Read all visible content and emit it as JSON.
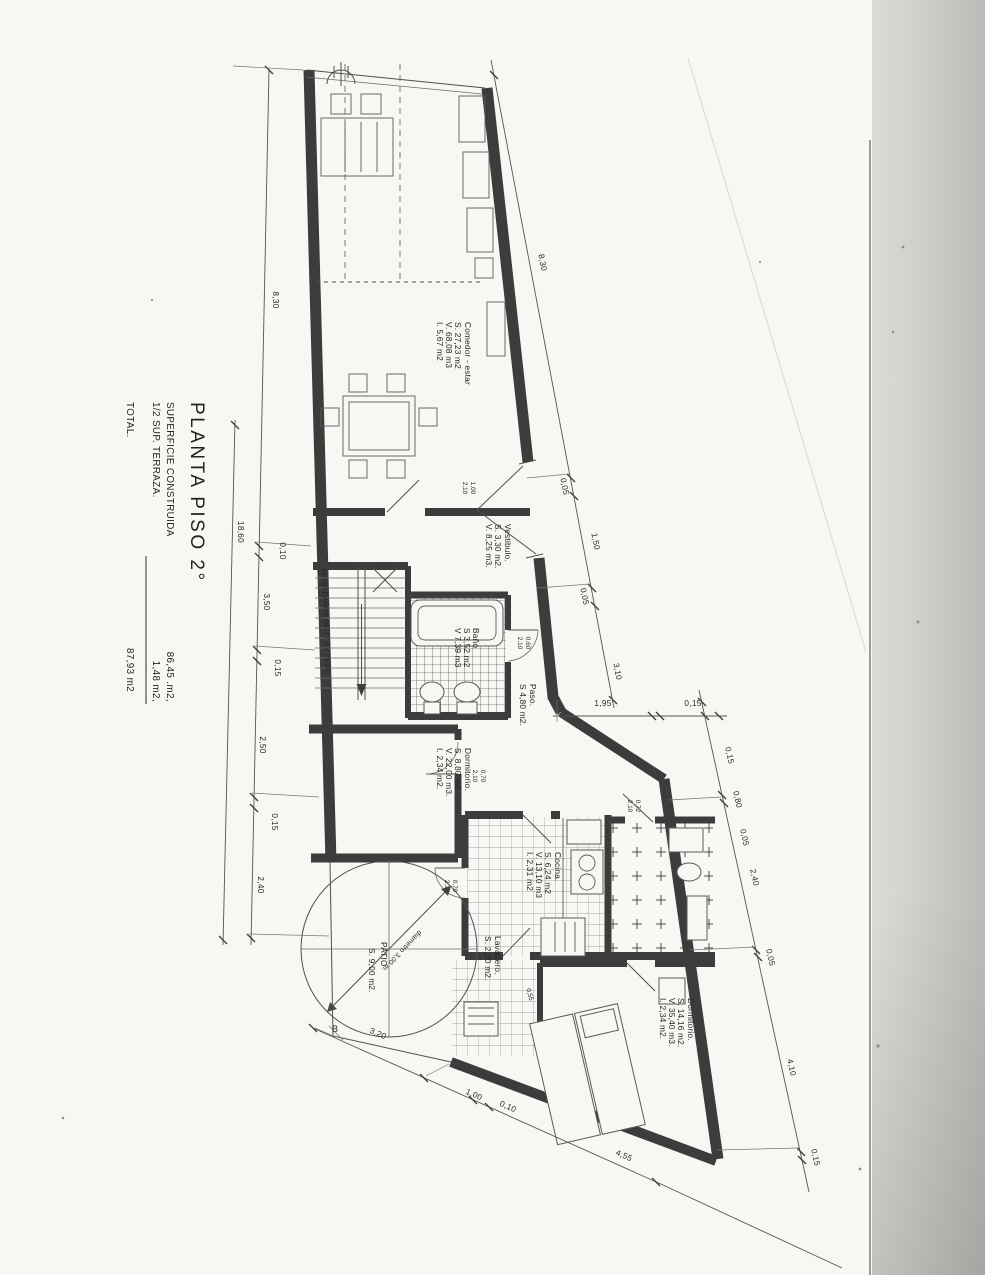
{
  "title_block": {
    "title": "PLANTA  PISO  2°",
    "rows": [
      {
        "label": "SUPERFICIE CONSTRUIDA",
        "value": "86,45 .m2,"
      },
      {
        "label": "1/2 SUP. TERRAZA.",
        "value": "1,48  m2,"
      },
      {
        "label": "TOTAL.",
        "value": "87,93  m2"
      }
    ]
  },
  "rooms": [
    {
      "name": "Comedor - estar",
      "lines": [
        "S. 27,23  m2",
        "V. 68,08  m3",
        "I.  5,67  m2"
      ]
    },
    {
      "name": "Vestibulo.",
      "lines": [
        "S. 3,30  m2.",
        "V. 8,25  m3."
      ]
    },
    {
      "name": "Baño",
      "lines": [
        "S 3,52 m2",
        "V 7,39 m3"
      ]
    },
    {
      "name": "Paso.",
      "lines": [
        "S 4,80  m2."
      ]
    },
    {
      "name": "Dormitorio.",
      "lines": [
        "S. 8,80  m2.",
        "V. 22,00  m3.",
        "I.  2,34  m2."
      ]
    },
    {
      "name": "Cocina.",
      "lines": [
        "S. 6,24  m2",
        "V. 13,10  m3",
        "I.  2,31  m2"
      ]
    },
    {
      "name": "Lavadero.",
      "lines": [
        "S. 2,20 m2."
      ]
    },
    {
      "name": "PATIO",
      "lines": [
        "S. 9,00 m2."
      ]
    },
    {
      "name": "Dormitorio.",
      "lines": [
        "S. 14,16 m2.",
        "V. 35,40 m3.",
        "I.  2,34 m2."
      ]
    }
  ],
  "annotations": {
    "patio_diameter": "diametro  3,00 m.",
    "stairs": "14 PELDAÑOS DE 17,4 x 25,00",
    "marker_b": "B"
  },
  "dimensions": {
    "left_chain": [
      "8,30",
      "0,10",
      "3,50",
      "0,15",
      "2,50",
      "0,15",
      "2,40"
    ],
    "left_total": "18,60",
    "top_chain": [
      "8,30",
      "0,05",
      "1,50",
      "0,05",
      "3,10"
    ],
    "step_chain": [
      "1,95",
      "0,15"
    ],
    "right_chain": [
      "0,15",
      "0,80",
      "0,05",
      "2,40",
      "0,05",
      "4,10",
      "0,15"
    ],
    "bottom_chain": [
      "3,20",
      "1,00",
      "0,10",
      "4,55"
    ],
    "door_tags": [
      {
        "w": "1,00",
        "h": "2,10"
      },
      {
        "w": "0,60",
        "h": "2,10"
      },
      {
        "w": "0,70",
        "h": "2,10"
      },
      {
        "w": "0,72",
        "h": "2,10"
      },
      {
        "w": "0,70",
        "h": "2,10"
      }
    ],
    "lavadero_tag": "0,55"
  }
}
